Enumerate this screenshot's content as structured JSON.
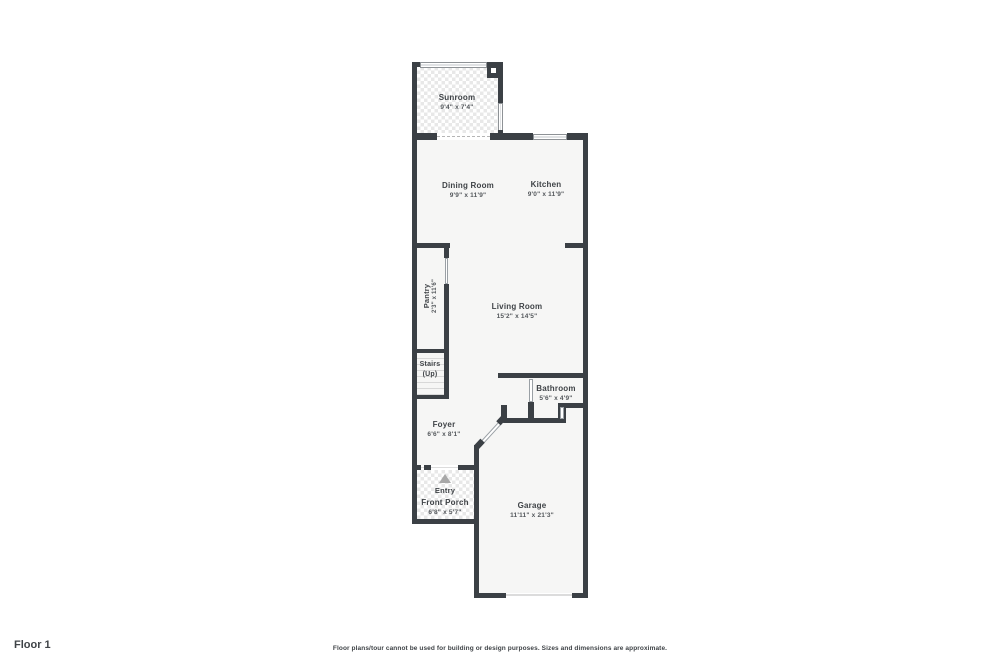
{
  "page": {
    "floor_label": "Floor 1",
    "disclaimer": "Floor plans/tour cannot be used for building or design purposes. Sizes and dimensions are approximate."
  },
  "colors": {
    "wall": "#3b4045",
    "room_floor": "#f6f6f5",
    "tile_grout": "#e8e8e8",
    "label_text": "#3f4347",
    "dimension_text": "#54585c",
    "entry_arrow": "#a8a8a8",
    "background": "#ffffff"
  },
  "rooms": [
    {
      "id": "sunroom",
      "name": "Sunroom",
      "dims": "9'4\" x 7'4\""
    },
    {
      "id": "dining-room",
      "name": "Dining Room",
      "dims": "9'9\" x 11'9\""
    },
    {
      "id": "kitchen",
      "name": "Kitchen",
      "dims": "9'0\" x 11'9\""
    },
    {
      "id": "pantry",
      "name": "Pantry",
      "dims": "2'3\" x 11'6\""
    },
    {
      "id": "living-room",
      "name": "Living Room",
      "dims": "15'2\" x 14'5\""
    },
    {
      "id": "stairs",
      "name": "Stairs",
      "dims": "(Up)"
    },
    {
      "id": "bathroom",
      "name": "Bathroom",
      "dims": "5'6\" x 4'9\""
    },
    {
      "id": "foyer",
      "name": "Foyer",
      "dims": "6'6\" x 8'1\""
    },
    {
      "id": "entry",
      "name": "Entry",
      "dims": ""
    },
    {
      "id": "front-porch",
      "name": "Front Porch",
      "dims": "6'8\" x 5'7\""
    },
    {
      "id": "garage",
      "name": "Garage",
      "dims": "11'11\" x 21'3\""
    }
  ]
}
